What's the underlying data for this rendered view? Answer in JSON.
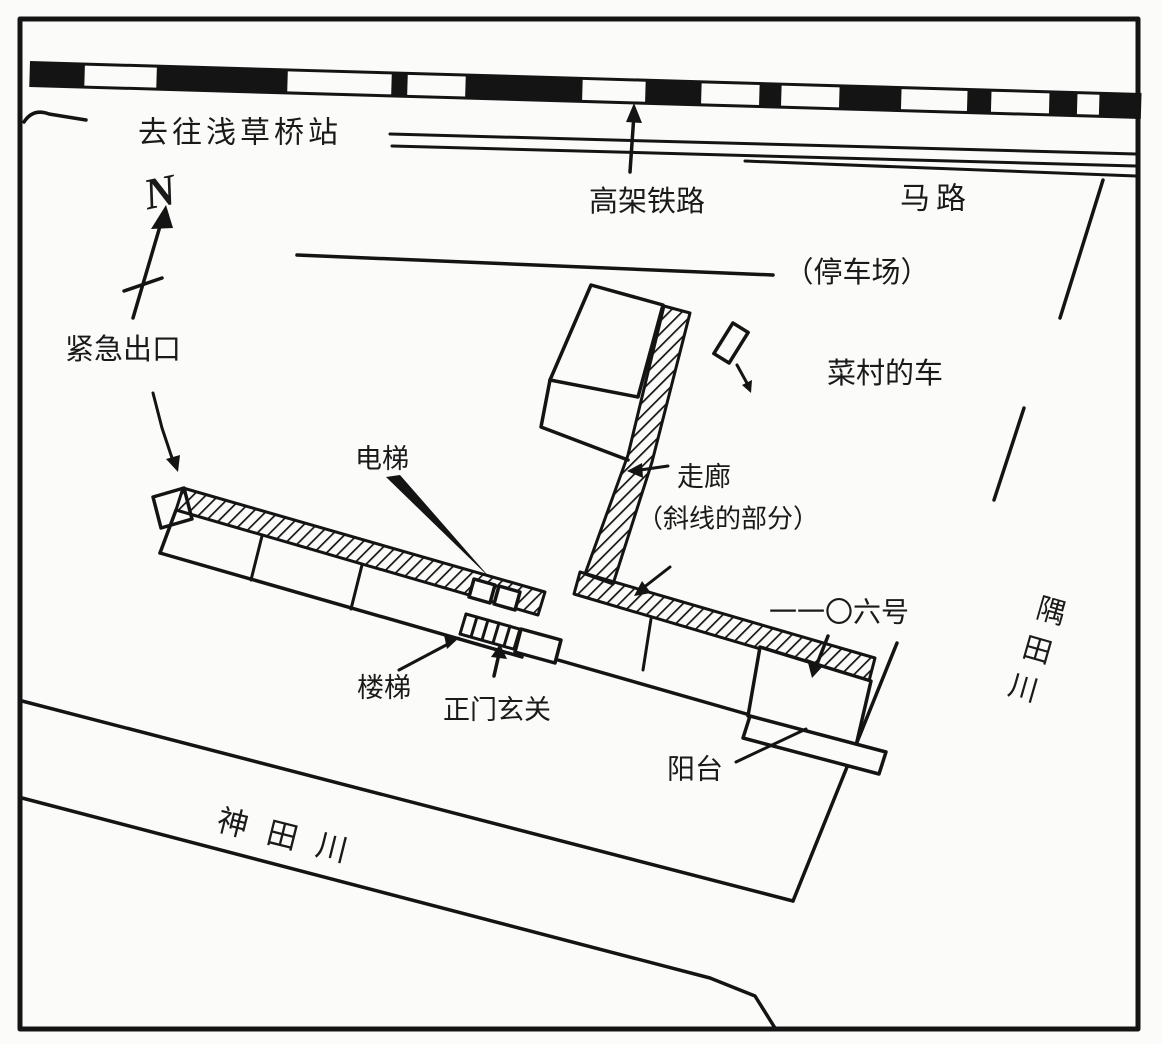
{
  "figure": {
    "kind": "hand-drawn site plan sketch",
    "compass": {
      "north_letter": "N"
    },
    "colors": {
      "ink": "#141414",
      "paper": "#fbfbfa"
    },
    "labels": {
      "to_station": "去往浅草桥站",
      "elevated_railway": "高架铁路",
      "road": "马路",
      "parking_lot": "（停车场）",
      "namura_car": "菜村的车",
      "emergency_exit": "紧急出口",
      "elevator": "电梯",
      "corridor": "走廊",
      "corridor_note": "（斜线的部分）",
      "room_number": "一一〇六号",
      "stairs": "楼梯",
      "main_entrance": "正门玄关",
      "balcony": "阳台",
      "kanda_river": "神田川",
      "sumida_river_chars": [
        "隅",
        "田",
        "川"
      ]
    }
  }
}
